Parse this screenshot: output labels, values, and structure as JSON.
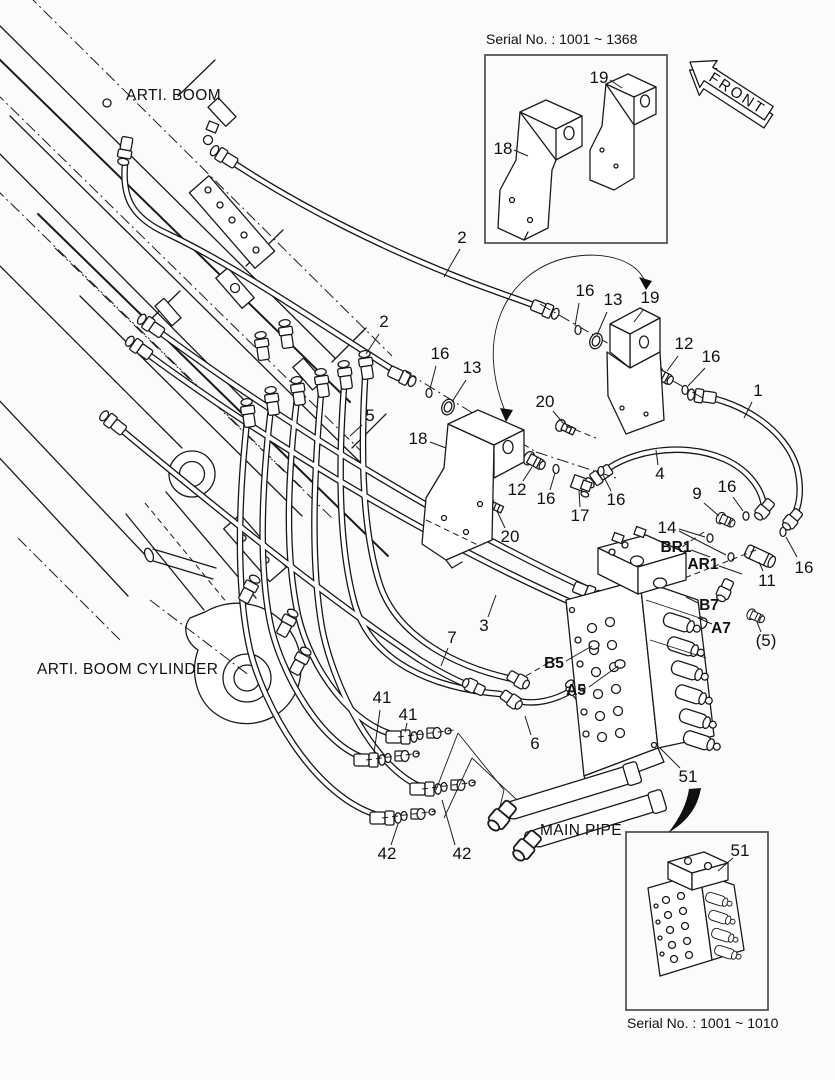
{
  "page": {
    "background": "#fbfbfa",
    "line_color": "#1a1a1a"
  },
  "labels": {
    "arti_boom": "ARTI. BOOM",
    "arti_boom_cylinder": "ARTI. BOOM CYLINDER",
    "main_pipe": "MAIN PIPE"
  },
  "front_arrow": {
    "label": "FRONT"
  },
  "insets": {
    "top": {
      "caption": "Serial No. : 1001 ~ 1368",
      "parts": [
        "18",
        "19"
      ]
    },
    "bottom": {
      "caption": "Serial No. : 1001 ~ 1010",
      "parts": [
        "51"
      ]
    }
  },
  "callouts": [
    {
      "text": "2",
      "x": 462,
      "y": 238
    },
    {
      "text": "16",
      "x": 585,
      "y": 291
    },
    {
      "text": "13",
      "x": 613,
      "y": 300
    },
    {
      "text": "19",
      "x": 650,
      "y": 298
    },
    {
      "text": "2",
      "x": 384,
      "y": 322
    },
    {
      "text": "16",
      "x": 440,
      "y": 354
    },
    {
      "text": "13",
      "x": 472,
      "y": 368
    },
    {
      "text": "12",
      "x": 684,
      "y": 344
    },
    {
      "text": "16",
      "x": 711,
      "y": 357
    },
    {
      "text": "1",
      "x": 758,
      "y": 391
    },
    {
      "text": "5",
      "x": 370,
      "y": 416
    },
    {
      "text": "18",
      "x": 418,
      "y": 439
    },
    {
      "text": "20",
      "x": 545,
      "y": 402
    },
    {
      "text": "12",
      "x": 517,
      "y": 490
    },
    {
      "text": "16",
      "x": 546,
      "y": 499
    },
    {
      "text": "17",
      "x": 580,
      "y": 516
    },
    {
      "text": "16",
      "x": 616,
      "y": 500
    },
    {
      "text": "20",
      "x": 510,
      "y": 537
    },
    {
      "text": "4",
      "x": 660,
      "y": 474
    },
    {
      "text": "9",
      "x": 697,
      "y": 494
    },
    {
      "text": "16",
      "x": 727,
      "y": 487
    },
    {
      "text": "14",
      "x": 667,
      "y": 528
    },
    {
      "text": "11",
      "x": 767,
      "y": 581
    },
    {
      "text": "16",
      "x": 804,
      "y": 568
    },
    {
      "text": "(5)",
      "x": 766,
      "y": 641
    },
    {
      "text": "3",
      "x": 484,
      "y": 626
    },
    {
      "text": "7",
      "x": 452,
      "y": 638
    },
    {
      "text": "6",
      "x": 535,
      "y": 744
    },
    {
      "text": "41",
      "x": 382,
      "y": 698
    },
    {
      "text": "41",
      "x": 408,
      "y": 715
    },
    {
      "text": "42",
      "x": 387,
      "y": 854
    },
    {
      "text": "42",
      "x": 462,
      "y": 854
    },
    {
      "text": "51",
      "x": 688,
      "y": 777
    },
    {
      "text": "18",
      "x": 503,
      "y": 149
    },
    {
      "text": "19",
      "x": 599,
      "y": 78
    },
    {
      "text": "51",
      "x": 740,
      "y": 851
    },
    {
      "text": "BR1",
      "x": 676,
      "y": 548,
      "bold": true
    },
    {
      "text": "AR1",
      "x": 703,
      "y": 565,
      "bold": true
    },
    {
      "text": "B7",
      "x": 709,
      "y": 606,
      "bold": true
    },
    {
      "text": "A7",
      "x": 721,
      "y": 629,
      "bold": true
    },
    {
      "text": "B5",
      "x": 554,
      "y": 664,
      "bold": true
    },
    {
      "text": "A5",
      "x": 576,
      "y": 691,
      "bold": true
    }
  ]
}
